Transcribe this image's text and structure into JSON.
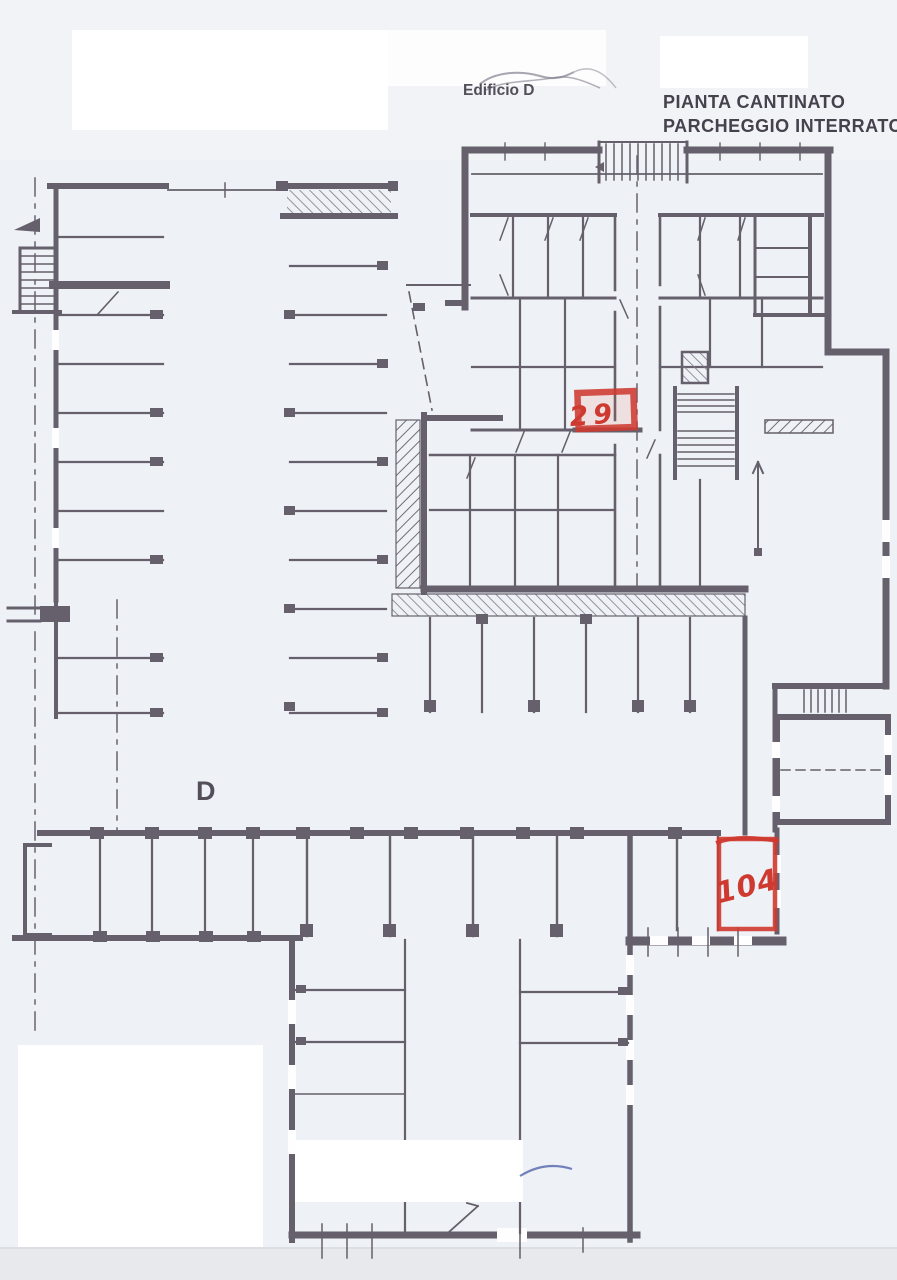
{
  "plan": {
    "building_label": "Edificio D",
    "title_line1": "PIANTA CANTINATO",
    "title_line2": "PARCHEGGIO INTERRATO",
    "zone_label": "D",
    "highlights": [
      {
        "label": "29"
      },
      {
        "label": "104"
      }
    ],
    "colors": {
      "paper": "#eef1f5",
      "ink": "#5e5964",
      "highlight_red": "#cf3a30",
      "pen_blue": "#5b6bb0",
      "redaction_white": "#ffffff"
    }
  }
}
